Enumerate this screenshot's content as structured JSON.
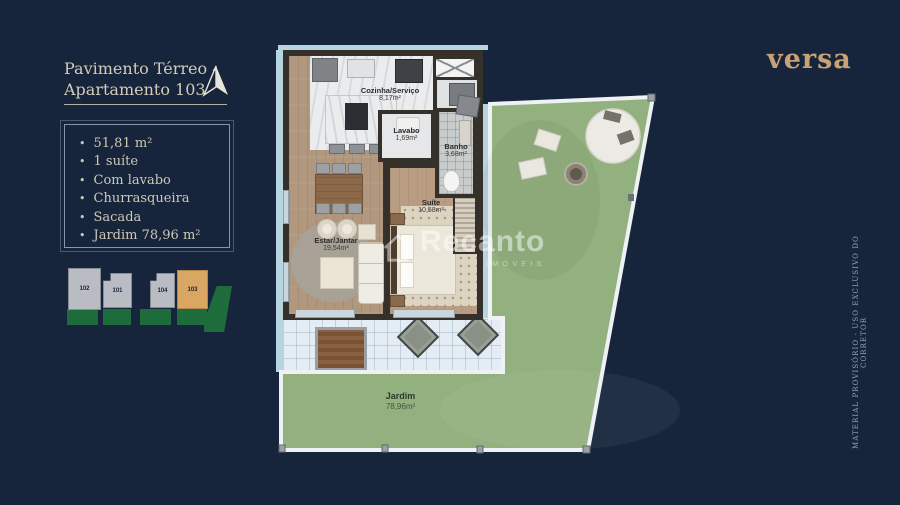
{
  "page": {
    "background": "#16253c"
  },
  "header": {
    "title_line1": "Pavimento Térreo -",
    "title_line2": "Apartamento 103"
  },
  "brand": {
    "logo_text": "versa",
    "color": "#c8a274"
  },
  "features": {
    "items": [
      "51,81 m²",
      "1 suíte",
      "Com lavabo",
      "Churrasqueira",
      "Sacada",
      "Jardim 78,96 m²"
    ]
  },
  "minimap": {
    "units": [
      {
        "id": "102",
        "highlighted": false
      },
      {
        "id": "101",
        "highlighted": false
      },
      {
        "id": "104",
        "highlighted": false
      },
      {
        "id": "103",
        "highlighted": true
      }
    ],
    "highlight_color": "#d9a763"
  },
  "floorplan": {
    "rooms": {
      "cozinha": {
        "name": "Cozinha/Serviço",
        "area": "8,17m²"
      },
      "lavabo": {
        "name": "Lavabo",
        "area": "1,69m²"
      },
      "banho": {
        "name": "Banho",
        "area": "3,68m²"
      },
      "suite": {
        "name": "Suíte",
        "area": "10,58m²"
      },
      "estar": {
        "name": "Estar/Jantar",
        "area": "19,54m²"
      },
      "jardim": {
        "name": "Jardim",
        "area": "78,96m²"
      }
    },
    "watermark": {
      "brand": "Recanto",
      "sub": "IMÓVEIS"
    }
  },
  "side_note": {
    "text": "MATERIAL PROVISÓRIO - USO EXCLUSIVO DO CORRETOR"
  },
  "colors": {
    "background": "#16253c",
    "accent_gold": "#c8a274",
    "cream_text": "#d3cbb8",
    "garden_green": "#93b07f",
    "minimap_green": "#1e6b3c",
    "walkway_blue": "#b7d4e1",
    "wall_dark": "#35302a",
    "unit_gray": "#b9bdc3"
  }
}
